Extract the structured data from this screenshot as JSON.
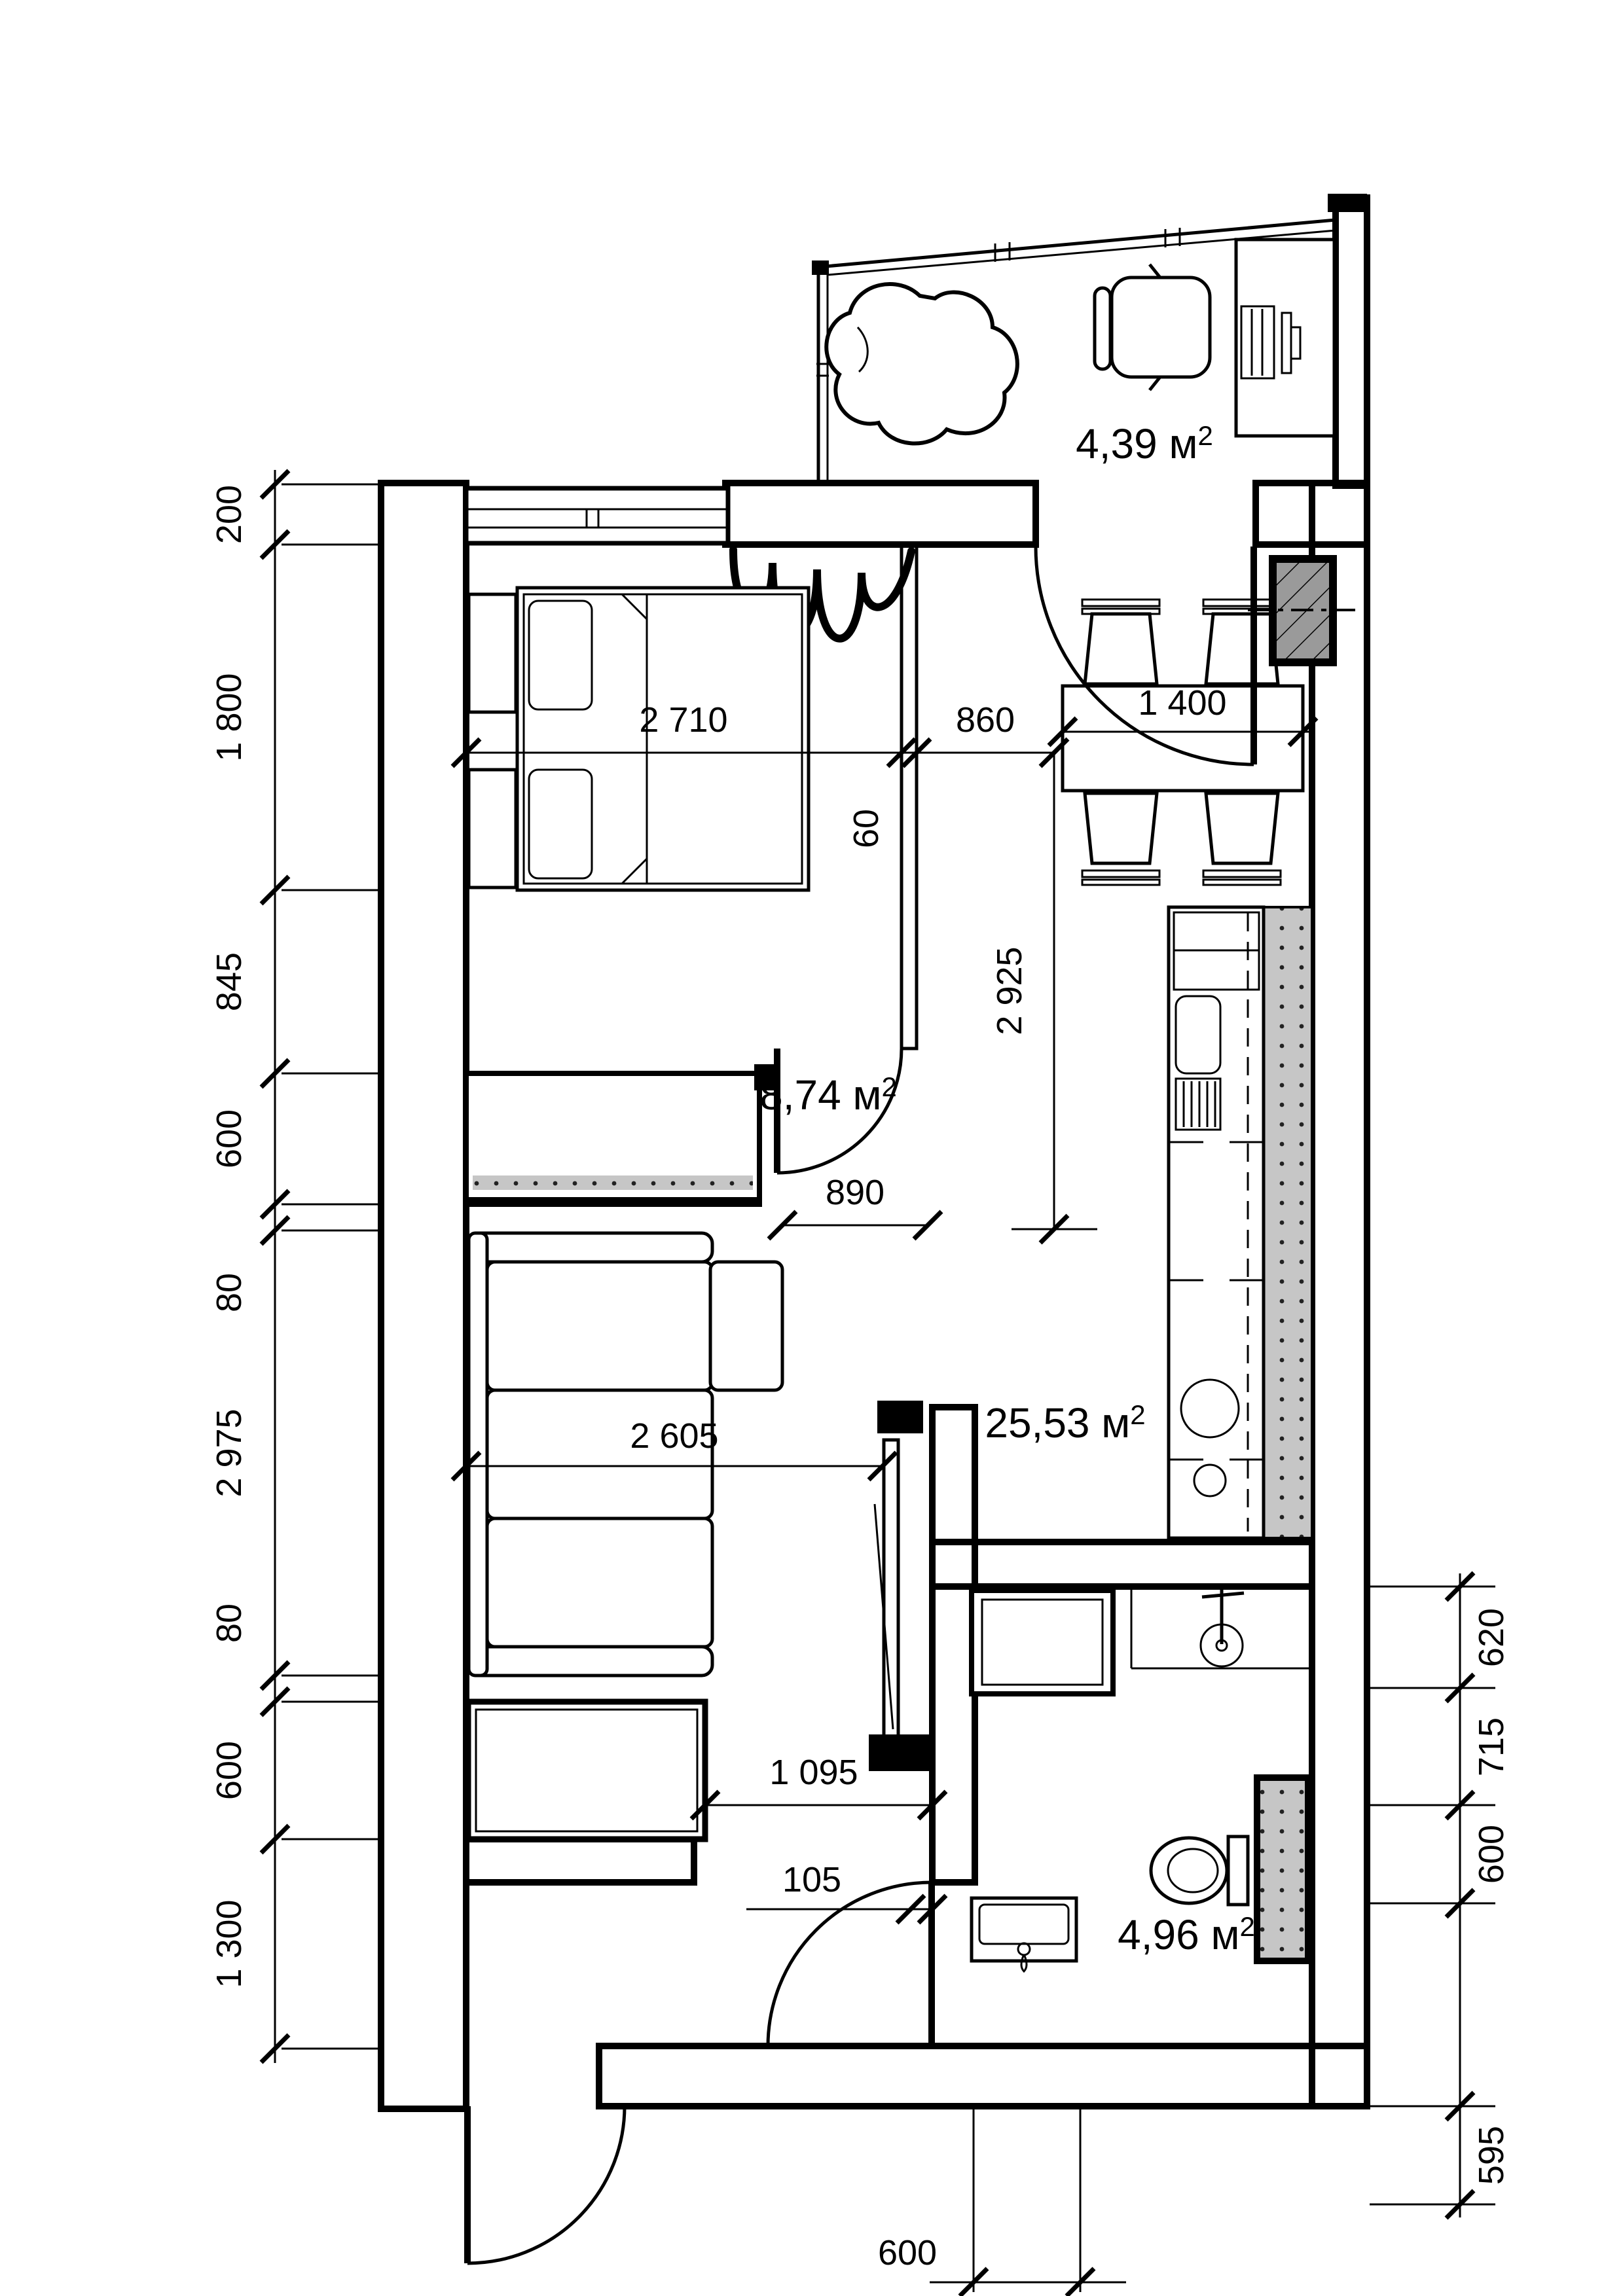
{
  "title": "Studio apartment floor plan",
  "rooms": {
    "balcony": {
      "area": "4,39 м",
      "sup": "2"
    },
    "bedroom": {
      "area": "8,74 м",
      "sup": "2"
    },
    "living_kitchen": {
      "area": "25,53 м",
      "sup": "2"
    },
    "bathroom": {
      "area": "4,96 м",
      "sup": "2"
    }
  },
  "dims": {
    "left": [
      "200",
      "1 800",
      "845",
      "600",
      "80",
      "2 975",
      "80",
      "600",
      "1 300"
    ],
    "right": [
      "620",
      "715",
      "600",
      "595"
    ],
    "bedroom_width": "2 710",
    "opening": "860",
    "partition": "60",
    "corridor": "2 925",
    "table": "1 400",
    "passage": "890",
    "living_width": "2 605",
    "hall_width": "1 095",
    "hall_offset": "105",
    "basin": "600"
  },
  "colors": {
    "wall": "#b3b3b3",
    "vent": "#9a9a9a",
    "strip": "#c6c6c6",
    "line": "#000000"
  }
}
